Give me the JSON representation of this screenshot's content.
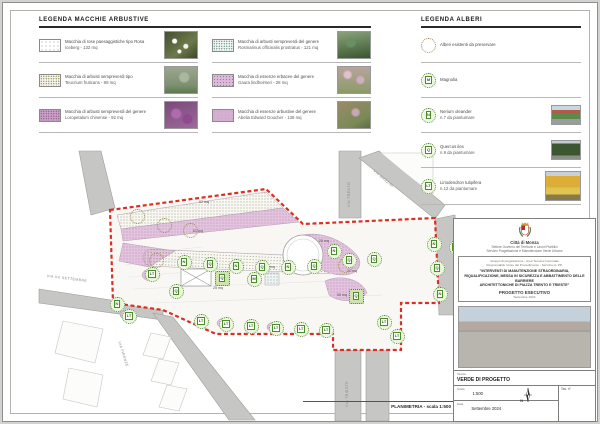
{
  "page": {
    "caption": "PLANIMETRIA - scala 1:500"
  },
  "legend_shrubs": {
    "title": "LEGENDA MACCHIE ARBUSTIVE",
    "items": [
      {
        "line1": "Macchia di rose paesaggistiche tipo Rosa",
        "line2": "Iceberg - 132 mq"
      },
      {
        "line1": "Macchia di arbusti sempreverdi tipo",
        "line2": "Teucrium fruticans - 89 mq"
      },
      {
        "line1": "Macchia di arbusti sempreverdi del genere",
        "line2": "Loropetalum chinense - 92 mq"
      },
      {
        "line1": "Macchia di arbusti sempreverdi del genere",
        "line2": "Rosmarinus officinalis prostratus - 121 mq"
      },
      {
        "line1": "Macchia di essenze erbacee del genere",
        "line2": "Gaura lindheimeri - 28 mq"
      },
      {
        "line1": "Macchia di essenze arbustive del genere",
        "line2": "Abelia Edward Goucher - 139 mq"
      }
    ]
  },
  "legend_trees": {
    "title": "LEGENDA ALBERI",
    "items": [
      {
        "letter": "",
        "line1": "Alberi esistenti da preservare",
        "line2": ""
      },
      {
        "letter": "M",
        "line1": "Magnolia",
        "line2": ""
      },
      {
        "letter": "N",
        "line1": "Nerium oleander",
        "line2": "n.7 da piantumare"
      },
      {
        "letter": "Q",
        "line1": "Quercus ilex",
        "line2": "n.9 da piantumare"
      },
      {
        "letter": "LT",
        "line1": "Liriodendron tulipifera",
        "line2": "n.12 da piantumare"
      }
    ]
  },
  "plan": {
    "species": {
      "magnolia": {
        "letter": "M"
      },
      "nerium": {
        "letter": "N"
      },
      "quercus": {
        "letter": "Q"
      },
      "liriodendron": {
        "letter": "LT"
      }
    },
    "areas": {
      "a62": "62 mq",
      "a61": "61 mq",
      "a25": "25 mq",
      "a24": "24 mq",
      "a28": "28 mq",
      "a50": "50 mq",
      "a21": "21 mq"
    },
    "streets": {
      "s1": "VIA XX SETTEMBRE",
      "s2": "VIA MAZZINI",
      "s3": "VIA TRENTO",
      "s4": "VIA TRIESTE",
      "s5": "VIA FIRENZE"
    }
  },
  "titleblock": {
    "municipality": "Città di Monza",
    "dept1": "Settore Governo del Territorio e Lavori Pubblici",
    "dept2": "Servizio Progettazione e Manutenzione Verde Urbano",
    "consultants1": "Gruppo di progettazione - Area Tecnica Comunale",
    "consultants2": "Responsabile Unico del Procedimento - Servizio LL.PP.",
    "title1": "\"INTERVENTI DI MANUTENZIONE STRAORDINARIA,",
    "title2": "RIQUALIFICAZIONE, MESSA IN SICUREZZA E ABBATTIMENTO DELLE BARRIERE",
    "title3": "ARCHITETTONICHE DI PIAZZA TRENTO E TRIESTE\"",
    "phase": "PROGETTO ESECUTIVO",
    "phase_note": "Settembre 2024",
    "subject_label": "Tavola",
    "subject": "VERDE DI PROGETTO",
    "scale_label": "Scala",
    "scale": "1:500",
    "north_label": "N",
    "sheet_no_label": "Tav. n°",
    "date_label": "Data",
    "date": "Settembre 2024"
  },
  "colors": {
    "boundary": "#d93025",
    "bed_pink": "#e3c4df",
    "tree_green": "#4e8a2e",
    "existing_olive": "#a08c50"
  }
}
